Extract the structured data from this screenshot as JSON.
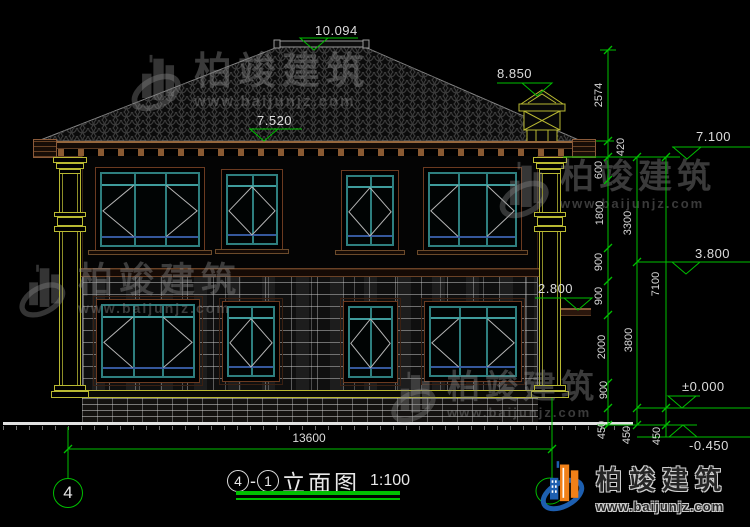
{
  "colors": {
    "dim_green": "#00bf00",
    "dim_text": "#dcdcdc",
    "column_yellow": "#b9b932",
    "frame_teal": "#2e7f7f",
    "frame_blue": "#35589c",
    "trim_brown": "#6b4226",
    "logo_blue": "#1d5fb0",
    "logo_orange": "#f08018"
  },
  "levels": {
    "peak": "10.094",
    "chimney_top": "8.850",
    "eave": "7.520",
    "roof_board": "7.100",
    "second_floor": "3.800",
    "canopy": "2.800",
    "first_floor": "±0.000",
    "grade": "-0.450"
  },
  "chains": {
    "c1": [
      "2574",
      "420",
      "600",
      "1800",
      "900",
      "900",
      "2000",
      "900",
      "450"
    ],
    "c2": [
      "3300",
      "3800",
      "450"
    ],
    "c3": [
      "7100",
      "450"
    ]
  },
  "overall": {
    "width": "13600"
  },
  "grid": {
    "left_bubble": "4"
  },
  "titleblock": {
    "num1": "4",
    "dash": "-",
    "num2": "1",
    "name": "立面图",
    "scale": "1:100"
  },
  "watermark": {
    "brand": "柏竣建筑",
    "site": "www.baijunjz.com"
  },
  "logo": {
    "brand": "柏竣建筑",
    "site": "www.baijunjz.com"
  }
}
